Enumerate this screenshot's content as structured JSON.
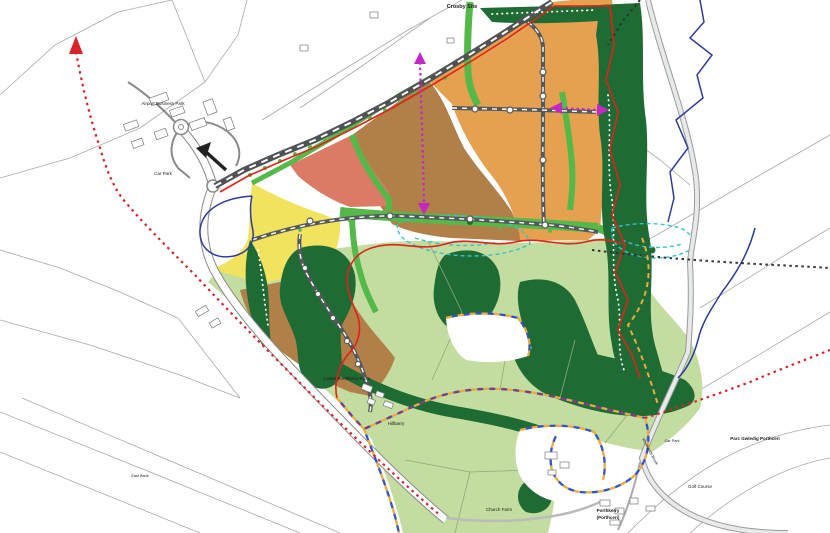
{
  "map": {
    "labels": {
      "crosby_site": "Crosby Site",
      "airport_business_park": "Airport Business Park",
      "car_park_west": "Car Park",
      "east_bank": "East Bank",
      "lower_porthkerry_farm": "Lower Porthkerry Farm",
      "hillbarry": "Hillbarry",
      "church_farm": "Church Farm",
      "porthkerry_en": "Porthkerry",
      "porthkerry_cy": "(Porthceri)",
      "parc_gwledig": "Parc Gwledig Porthceri",
      "golf_course": "Golf Course",
      "car_park_east": "Car Park",
      "whitelands_brook": "Whitelands Brook"
    },
    "colors": {
      "zone_residential_orange": "#E5A050",
      "zone_residential_brown": "#B08048",
      "zone_mixed_red": "#DB7B66",
      "zone_employment_yellow": "#F1E35E",
      "zone_open_space_green": "#C3DCA0",
      "zone_green_corridor": "#54B948",
      "zone_woodland_green": "#1E6B34",
      "line_site_boundary_red": "#E32119",
      "line_footpath_red": "#D8232A",
      "line_boundary_orange": "#F2A93B",
      "line_boundary_blue": "#2F55C9",
      "line_watercourse_blue": "#2C3C9C",
      "line_drainage_teal": "#35C4C8",
      "line_connection_magenta": "#C428C4",
      "road_main_dark": "#4F5355"
    },
    "features": [
      {
        "name": "residential-zone-orange",
        "color": "#E5A050"
      },
      {
        "name": "residential-zone-brown",
        "color": "#B08048"
      },
      {
        "name": "mixed-use-zone-red",
        "color": "#DB7B66"
      },
      {
        "name": "employment-zone-yellow",
        "color": "#F1E35E"
      },
      {
        "name": "open-space-light-green",
        "color": "#C3DCA0"
      },
      {
        "name": "green-corridor",
        "color": "#54B948"
      },
      {
        "name": "woodland-dark-green",
        "color": "#1E6B34"
      },
      {
        "name": "site-boundary-red-line",
        "color": "#E32119"
      },
      {
        "name": "footpath-red-dotted",
        "color": "#D8232A"
      },
      {
        "name": "boundary-orange-blue-dashed",
        "color": "#F2A93B"
      },
      {
        "name": "watercourse-blue-line",
        "color": "#2C3C9C"
      },
      {
        "name": "existing-path-black-dotted",
        "color": "#333333"
      },
      {
        "name": "connection-magenta-dotted",
        "color": "#C428C4"
      },
      {
        "name": "drainage-teal-dashed",
        "color": "#35C4C8"
      },
      {
        "name": "main-road-dashed",
        "color": "#4F5355"
      }
    ]
  }
}
